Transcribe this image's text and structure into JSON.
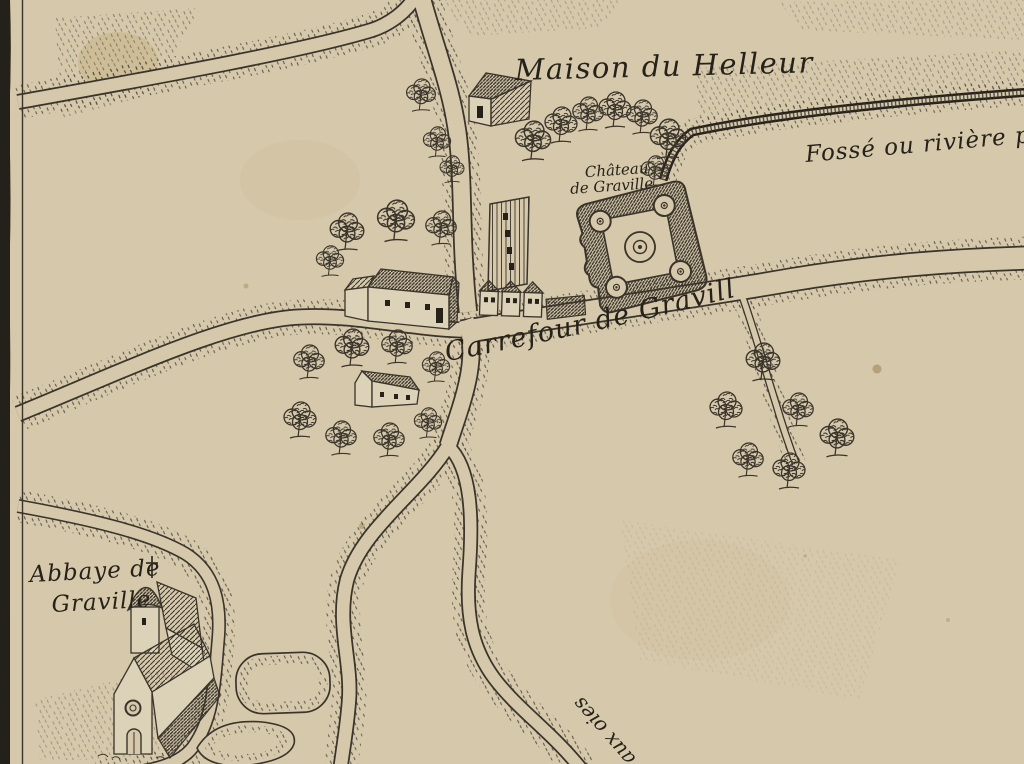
{
  "map": {
    "labels": {
      "maison": "Maison du Helleur",
      "fosse": "Fossé ou rivière po",
      "chateau_l1": "Château",
      "chateau_l2": "de Graville",
      "carrefour": "Carrefour de Graville",
      "abbaye_l1": "Abbaye de",
      "abbaye_l2": "Graville",
      "oies": "e aux oies"
    },
    "features": [
      {
        "name": "chateau-fort-symbol",
        "desc": "square fort plan with four round corner towers and central circular keep"
      },
      {
        "name": "abbey-church-illustration",
        "desc": "church with cross-topped spire, rose window and steep nave roof"
      },
      {
        "name": "helleur-barn",
        "desc": "gabled barn north of the crossroads"
      },
      {
        "name": "tall-farm-building",
        "desc": "tall hatched building west of the chateau"
      },
      {
        "name": "row-houses",
        "desc": "three row houses at the crossroads"
      },
      {
        "name": "long-farm-building",
        "desc": "long farm building with annex among trees"
      },
      {
        "name": "hamlet-house",
        "desc": "small house surrounded by trees"
      },
      {
        "name": "tree-cluster",
        "desc": "engraved deciduous trees"
      },
      {
        "name": "roads",
        "desc": "double-line roads with stippled verges meeting at the Carrefour de Graville"
      },
      {
        "name": "fosse-channel",
        "desc": "hatched ditch or river channel along the north-east"
      },
      {
        "name": "abbey-enclosures",
        "desc": "rounded hedged enclosures south of the abbey"
      }
    ],
    "colors": {
      "paper": "#d5c8ab",
      "paper2": "#dcd2b8",
      "ink": "#3a342a",
      "inkdark": "#262119",
      "borderstrip": "#23211a",
      "stain": "#b89a55"
    }
  }
}
